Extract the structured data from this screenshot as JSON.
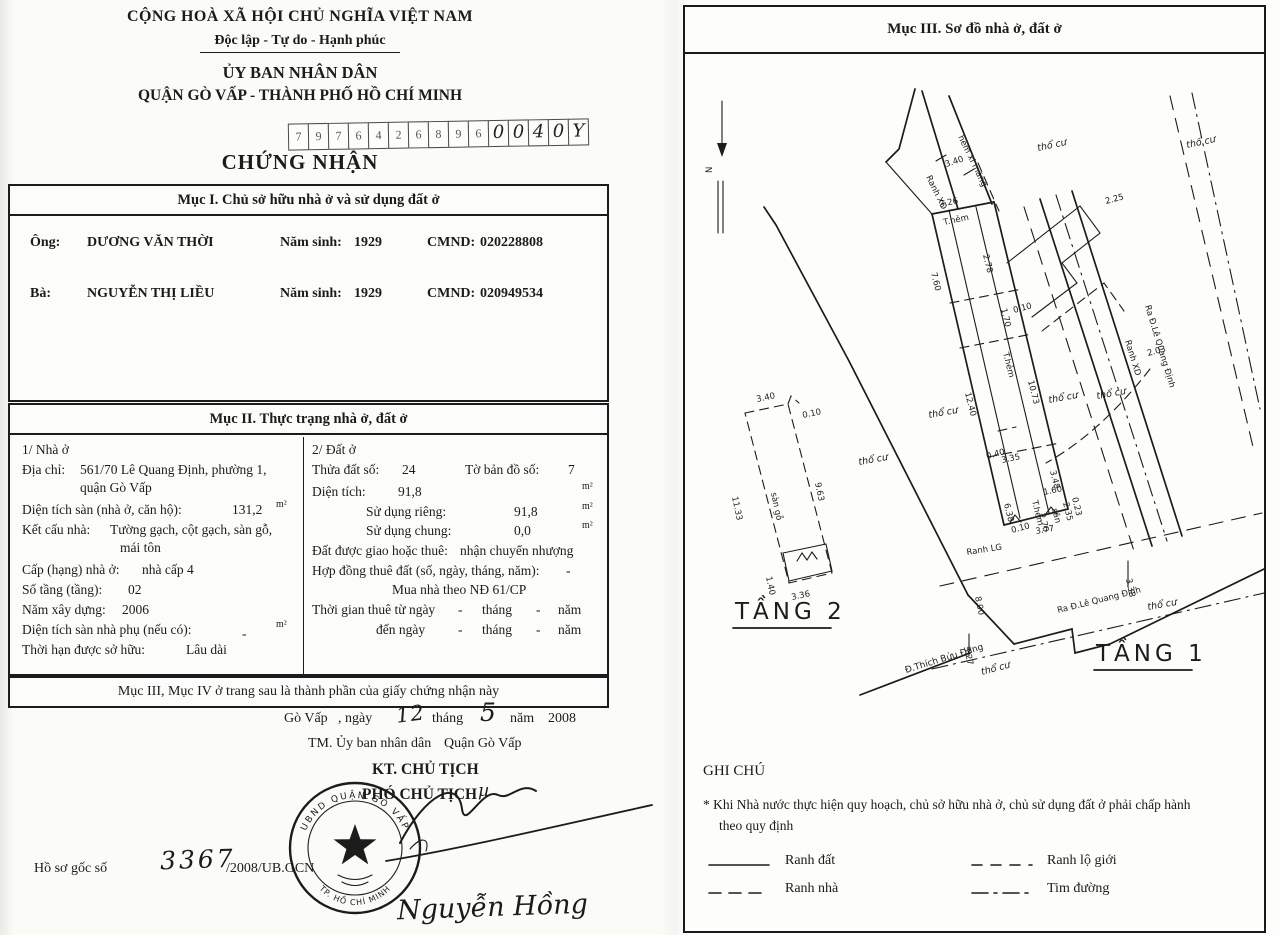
{
  "left_page": {
    "header": {
      "line1": "CỘNG HOÀ XÃ HỘI CHỦ NGHĨA VIỆT NAM",
      "line2": "Độc lập - Tự do - Hạnh phúc",
      "line3": "ỦY BAN NHÂN DÂN",
      "line4": "QUẬN GÒ VẤP - THÀNH PHỐ HỒ CHÍ MINH"
    },
    "serial_digits": [
      "7",
      "9",
      "7",
      "6",
      "4",
      "2",
      "6",
      "8",
      "9",
      "6",
      "0",
      "0",
      "4",
      "0",
      "Y"
    ],
    "doc_title": "CHỨNG NHẬN",
    "section1": {
      "title": "Mục I. Chủ sở hữu nhà ở và sử dụng đất ở",
      "owner1": {
        "prefix": "Ông:",
        "name": "DƯƠNG VĂN THỜI",
        "birth_label": "Năm sinh:",
        "birth": "1929",
        "id_label": "CMND:",
        "id": "020228808"
      },
      "owner2": {
        "prefix": "Bà:",
        "name": "NGUYỄN THỊ LIỀU",
        "birth_label": "Năm sinh:",
        "birth": "1929",
        "id_label": "CMND:",
        "id": "020949534"
      }
    },
    "section2": {
      "title": "Mục II. Thực trạng nhà ở, đất ở",
      "house": {
        "heading": "1/ Nhà ở",
        "address_label": "Địa chỉ:",
        "address1": "561/70 Lê Quang Định, phường 1,",
        "address2": "quận Gò Vấp",
        "floor_area_label": "Diện tích sàn (nhà ở, căn hộ):",
        "floor_area": "131,2",
        "unit": "m²",
        "structure_label": "Kết cấu nhà:",
        "structure1": "Tường gạch, cột gạch, sàn gỗ,",
        "structure2": "mái tôn",
        "grade_label": "Cấp (hạng) nhà ở:",
        "grade": "nhà cấp 4",
        "floors_label": "Số tầng (tầng):",
        "floors": "02",
        "year_label": "Năm xây dựng:",
        "year": "2006",
        "aux_label": "Diện tích sàn nhà phụ (nếu có):",
        "aux": "-",
        "tenure_label": "Thời hạn được sở hữu:",
        "tenure": "Lâu dài"
      },
      "land": {
        "heading": "2/ Đất ở",
        "plot_label": "Thửa đất số:",
        "plot": "24",
        "map_label": "Tờ bản đồ số:",
        "map": "7",
        "area_label": "Diện tích:",
        "area": "91,8",
        "unit": "m²",
        "private_label": "Sử dụng riêng:",
        "private": "91,8",
        "shared_label": "Sử dụng chung:",
        "shared": "0,0",
        "alloc_label": "Đất được giao hoặc thuê:",
        "alloc": "nhận chuyển nhượng",
        "contract_label": "Hợp đồng thuê đất (số, ngày, tháng, năm):",
        "contract": "-",
        "note": "Mua nhà theo NĐ 61/CP",
        "lease_from_label": "Thời gian thuê từ ngày",
        "lease_to_label": "đến ngày",
        "dash": "-",
        "thang": "tháng",
        "nam": "năm"
      }
    },
    "section3_note": "Mục III, Mục IV ở trang sau là thành phần của giấy chứng nhận này",
    "issue": {
      "place": "Gò Vấp",
      "ngay_label": ", ngày",
      "day": "12",
      "thang": "tháng",
      "month": "5",
      "nam": "năm",
      "year": "2008",
      "tm": "TM. Ủy ban nhân dân",
      "district": "Quận Gò Vấp",
      "kt": "KT. CHỦ TỊCH",
      "deputy": "PHÓ CHỦ TỊCH",
      "deputy_mark": "µ",
      "signer": "Nguyễn Hồng"
    },
    "seal": {
      "ring_top": "UBND QUẬN GÒ VẤP",
      "ring_bottom": "TP. HỒ CHÍ MINH"
    },
    "dossier": {
      "label": "Hồ sơ gốc số",
      "hand": "3367",
      "print": "/2008/UB.GCN"
    }
  },
  "right_page": {
    "header": "Mục III. Sơ đồ nhà ở, đất ở",
    "floor2": "TẦNG 2",
    "floor1": "TẦNG 1",
    "labels": {
      "north": "N",
      "ranh_xd": "Ranh XD",
      "hem_xi_mang": "hẻm xi măng",
      "t_hem": "T.hẻm",
      "tho_cu": "thổ cư",
      "ranh_lg": "Ranh LG",
      "san_go": "sàn gỗ",
      "san": "sân",
      "ra_le_quang_dinh": "Ra Đ.Lê Quang Định",
      "thich_buu_dang": "Đ.Thích Bửu Đăng"
    },
    "dims": {
      "alley_w": "3.40",
      "parcel_top": "3.26",
      "left_a": "7.60",
      "left_b": "12.40",
      "inner_a": "2.78",
      "inner_b": "1.70",
      "inner_c": "0.10",
      "right_a": "10.73",
      "mid_a": "0.40",
      "mid_b": "3.35",
      "mid_c": "3.48",
      "mid_d": "6.38",
      "mid_e": "1.60",
      "mid_f": "2.70",
      "mid_g": "2.35",
      "mid_h": "0.23",
      "mid_i": "0.10",
      "parcel_bottom": "3.77",
      "road_r_a": "2.25",
      "road_r_b": "2.03",
      "road_b_a": "3.38",
      "road_b_b": "8.00",
      "road_b_c": "3.27",
      "t2_top": "3.40",
      "t2_notch": "0.10",
      "t2_left": "11.33",
      "t2_right": "9.63",
      "t2_bl": "1.40",
      "t2_bottom": "3.36"
    },
    "legend": {
      "title": "GHI CHÚ",
      "note1": "* Khi Nhà nước thực hiện quy hoạch, chủ sở hữu nhà ở, chủ sử dụng đất ở phải chấp hành",
      "note2": "theo quy định",
      "items": [
        {
          "label": "Ranh đất"
        },
        {
          "label": "Ranh nhà"
        },
        {
          "label": "Ranh lộ giới"
        },
        {
          "label": "Tim đường"
        }
      ]
    }
  }
}
